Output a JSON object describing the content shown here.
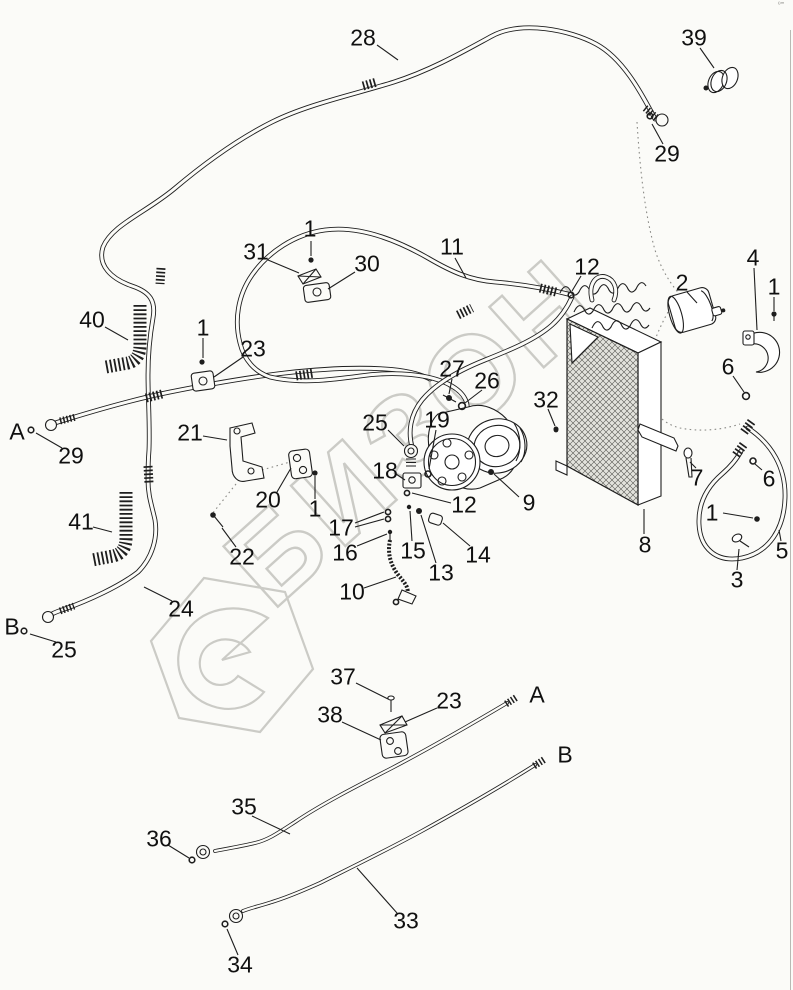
{
  "page": {
    "background": "#fbfbf8",
    "line_color": "#1e1e1e",
    "border_color": "#b9b9b4",
    "corner_mark": "º‴"
  },
  "watermark": {
    "text": "БИЗОН",
    "color": "#cbcbc6"
  },
  "callouts": [
    {
      "label": "28",
      "x": 363,
      "y": 38
    },
    {
      "label": "39",
      "x": 694,
      "y": 38
    },
    {
      "label": "29",
      "x": 667,
      "y": 154
    },
    {
      "label": "1",
      "x": 310,
      "y": 229
    },
    {
      "label": "31",
      "x": 256,
      "y": 252
    },
    {
      "label": "30",
      "x": 367,
      "y": 264
    },
    {
      "label": "11",
      "x": 452,
      "y": 247
    },
    {
      "label": "12",
      "x": 587,
      "y": 267
    },
    {
      "label": "2",
      "x": 682,
      "y": 283
    },
    {
      "label": "4",
      "x": 753,
      "y": 258
    },
    {
      "label": "1",
      "x": 774,
      "y": 287
    },
    {
      "label": "40",
      "x": 92,
      "y": 320
    },
    {
      "label": "1",
      "x": 203,
      "y": 328
    },
    {
      "label": "23",
      "x": 253,
      "y": 349
    },
    {
      "label": "27",
      "x": 452,
      "y": 369
    },
    {
      "label": "26",
      "x": 487,
      "y": 381
    },
    {
      "label": "32",
      "x": 546,
      "y": 400
    },
    {
      "label": "A",
      "x": 17,
      "y": 432
    },
    {
      "label": "29",
      "x": 71,
      "y": 456
    },
    {
      "label": "21",
      "x": 190,
      "y": 433
    },
    {
      "label": "25",
      "x": 375,
      "y": 423
    },
    {
      "label": "19",
      "x": 437,
      "y": 420
    },
    {
      "label": "6",
      "x": 728,
      "y": 367
    },
    {
      "label": "18",
      "x": 385,
      "y": 471
    },
    {
      "label": "20",
      "x": 268,
      "y": 500
    },
    {
      "label": "1",
      "x": 315,
      "y": 509
    },
    {
      "label": "12",
      "x": 464,
      "y": 505
    },
    {
      "label": "9",
      "x": 529,
      "y": 503
    },
    {
      "label": "7",
      "x": 697,
      "y": 478
    },
    {
      "label": "6",
      "x": 769,
      "y": 479
    },
    {
      "label": "41",
      "x": 81,
      "y": 522
    },
    {
      "label": "22",
      "x": 242,
      "y": 557
    },
    {
      "label": "17",
      "x": 341,
      "y": 528
    },
    {
      "label": "16",
      "x": 345,
      "y": 553
    },
    {
      "label": "15",
      "x": 413,
      "y": 551
    },
    {
      "label": "13",
      "x": 441,
      "y": 573
    },
    {
      "label": "14",
      "x": 478,
      "y": 555
    },
    {
      "label": "1",
      "x": 712,
      "y": 513
    },
    {
      "label": "5",
      "x": 782,
      "y": 551
    },
    {
      "label": "3",
      "x": 737,
      "y": 580
    },
    {
      "label": "10",
      "x": 352,
      "y": 592
    },
    {
      "label": "24",
      "x": 181,
      "y": 609
    },
    {
      "label": "8",
      "x": 645,
      "y": 545
    },
    {
      "label": "B",
      "x": 12,
      "y": 627
    },
    {
      "label": "25",
      "x": 64,
      "y": 650
    },
    {
      "label": "37",
      "x": 343,
      "y": 677
    },
    {
      "label": "23",
      "x": 449,
      "y": 701
    },
    {
      "label": "38",
      "x": 330,
      "y": 715
    },
    {
      "label": "A",
      "x": 537,
      "y": 695
    },
    {
      "label": "B",
      "x": 565,
      "y": 755
    },
    {
      "label": "35",
      "x": 244,
      "y": 807
    },
    {
      "label": "36",
      "x": 159,
      "y": 839
    },
    {
      "label": "33",
      "x": 406,
      "y": 921
    },
    {
      "label": "34",
      "x": 240,
      "y": 965
    }
  ]
}
